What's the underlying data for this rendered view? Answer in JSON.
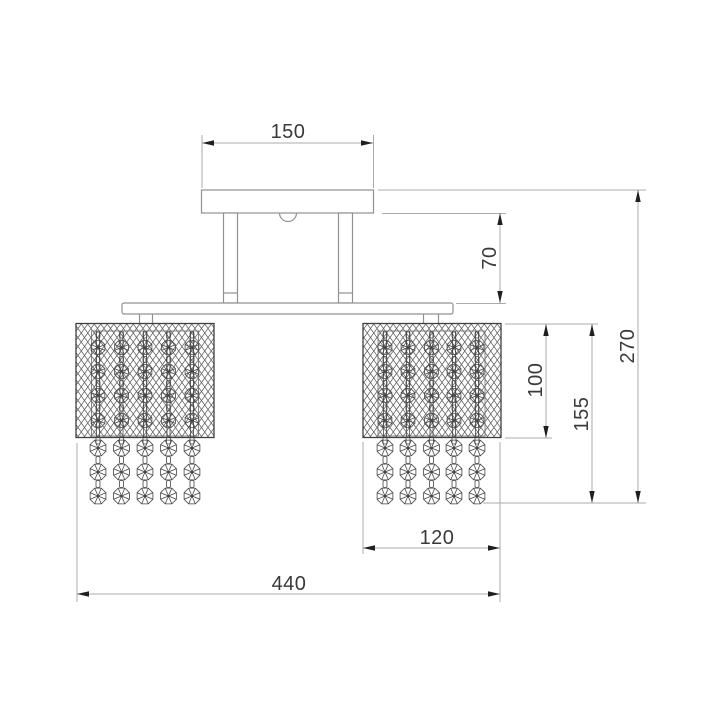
{
  "drawing": {
    "kind": "ceiling-chandelier front-view dimension drawing",
    "shade_count": 2,
    "strands_per_shade": 5,
    "crystal_rows_inside_shade": 4,
    "crystal_rows_below_shade": 3
  },
  "dimensions": {
    "canopy_width": "150",
    "stem_height": "70",
    "shade_height": "100",
    "shade_with_crystals_height": "155",
    "total_height": "270",
    "shade_width": "120",
    "total_width": "440"
  },
  "colors": {
    "background": "#ffffff",
    "object_line": "#919191",
    "dimension_line": "#ababab",
    "mesh_line": "#5a5a5a",
    "crystal_line": "#454545",
    "shade_border": "#3f3f3f",
    "inner_frame": "#6a6a6a",
    "arrow": "#1f1f1f",
    "text": "#3a3a3a"
  }
}
